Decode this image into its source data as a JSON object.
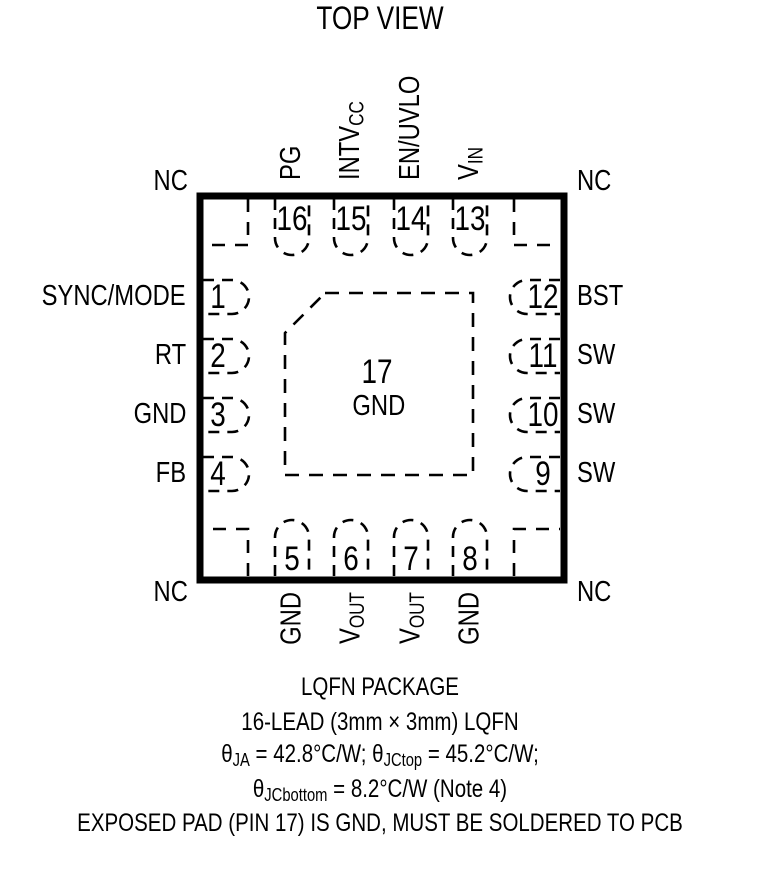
{
  "title": "TOP VIEW",
  "colors": {
    "ink": "#000000",
    "background": "#ffffff"
  },
  "package": {
    "center_pad": {
      "number": "17",
      "label": "GND"
    },
    "corner_labels": {
      "top_left": "NC",
      "top_right": "NC",
      "bottom_left": "NC",
      "bottom_right": "NC"
    },
    "pins_left": [
      {
        "number": "1",
        "name": "SYNC/MODE"
      },
      {
        "number": "2",
        "name": "RT"
      },
      {
        "number": "3",
        "name": "GND"
      },
      {
        "number": "4",
        "name": "FB"
      }
    ],
    "pins_right": [
      {
        "number": "12",
        "name": "BST"
      },
      {
        "number": "11",
        "name": "SW"
      },
      {
        "number": "10",
        "name": "SW"
      },
      {
        "number": "9",
        "name": "SW"
      }
    ],
    "pins_top": [
      {
        "number": "16",
        "name": "PG",
        "sub": ""
      },
      {
        "number": "15",
        "name": "INTV",
        "sub": "CC"
      },
      {
        "number": "14",
        "name": "EN/UVLO",
        "sub": ""
      },
      {
        "number": "13",
        "name": "V",
        "sub": "IN"
      }
    ],
    "pins_bottom": [
      {
        "number": "5",
        "name": "GND",
        "sub": ""
      },
      {
        "number": "6",
        "name": "V",
        "sub": "OUT"
      },
      {
        "number": "7",
        "name": "V",
        "sub": "OUT"
      },
      {
        "number": "8",
        "name": "GND",
        "sub": ""
      }
    ]
  },
  "footer": {
    "line1": "LQFN PACKAGE",
    "line2": "16-LEAD (3mm × 3mm) LQFN",
    "line3_parts": {
      "p0": "θ",
      "s0": "JA",
      "p1": " = 42.8°C/W; θ",
      "s1": "JCtop",
      "p2": " = 45.2°C/W;"
    },
    "line4_parts": {
      "p0": "θ",
      "s0": "JCbottom",
      "p1": " = 8.2°C/W (Note 4)"
    },
    "line5": "EXPOSED PAD (PIN 17) IS GND, MUST BE SOLDERED TO PCB"
  }
}
